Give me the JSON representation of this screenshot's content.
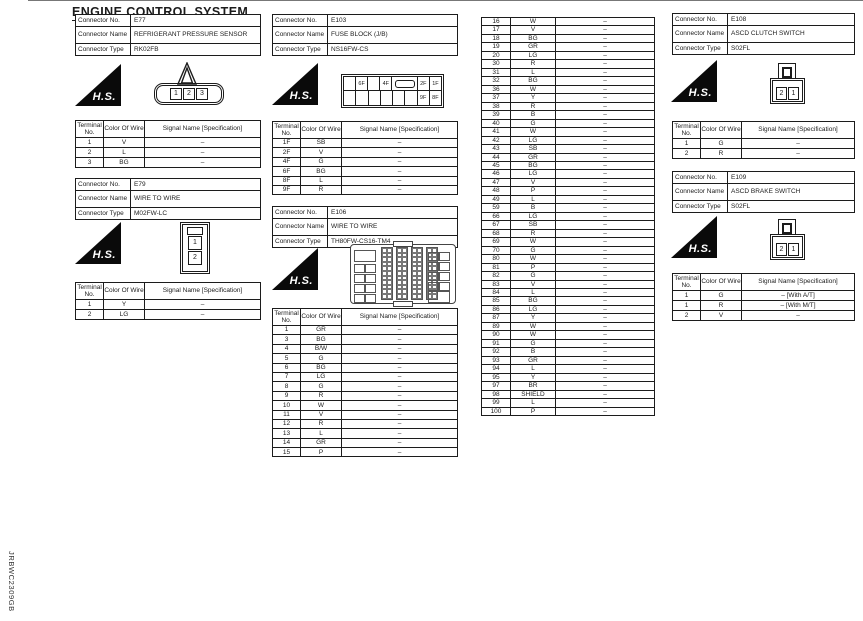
{
  "page": {
    "title": "ENGINE CONTROL SYSTEM",
    "doc_code": "JRBWC2309GB"
  },
  "labels": {
    "connector_no": "Connector No.",
    "connector_name": "Connector Name",
    "connector_type": "Connector Type",
    "terminal_no": "Terminal No.",
    "color_of_wire": "Color Of Wire",
    "signal_name": "Signal Name [Specification]",
    "hs_logo": "H.S."
  },
  "connectors": [
    {
      "no": "E77",
      "name": "REFRIGERANT PRESSURE SENSOR",
      "type": "RK02FB",
      "cavities": [
        "1",
        "2",
        "3"
      ],
      "terminals": [
        [
          "1",
          "V",
          "–"
        ],
        [
          "2",
          "L",
          "–"
        ],
        [
          "3",
          "BG",
          "–"
        ]
      ]
    },
    {
      "no": "E79",
      "name": "WIRE TO WIRE",
      "type": "M02FW-LC",
      "cavities": [
        "1",
        "2"
      ],
      "terminals": [
        [
          "1",
          "Y",
          "–"
        ],
        [
          "2",
          "LG",
          "–"
        ]
      ]
    },
    {
      "no": "E103",
      "name": "FUSE BLOCK (J/B)",
      "type": "NS16FW-CS",
      "fuse_top": [
        "",
        "6F",
        "",
        "4F",
        "",
        "2F",
        "1F"
      ],
      "fuse_bottom": [
        "",
        "",
        "",
        "",
        "",
        "",
        "9F",
        "8F"
      ],
      "terminals": [
        [
          "1F",
          "SB",
          "–"
        ],
        [
          "2F",
          "V",
          "–"
        ],
        [
          "4F",
          "G",
          "–"
        ],
        [
          "6F",
          "BG",
          "–"
        ],
        [
          "8F",
          "L",
          "–"
        ],
        [
          "9F",
          "R",
          "–"
        ]
      ]
    },
    {
      "no": "E106",
      "name": "WIRE TO WIRE",
      "type": "TH80FW-CS16-TM4",
      "terminals": [
        [
          "1",
          "GR",
          "–"
        ],
        [
          "3",
          "BG",
          "–"
        ],
        [
          "4",
          "B/W",
          "–"
        ],
        [
          "5",
          "G",
          "–"
        ],
        [
          "6",
          "BG",
          "–"
        ],
        [
          "7",
          "LG",
          "–"
        ],
        [
          "8",
          "G",
          "–"
        ],
        [
          "9",
          "R",
          "–"
        ],
        [
          "10",
          "W",
          "–"
        ],
        [
          "11",
          "V",
          "–"
        ],
        [
          "12",
          "R",
          "–"
        ],
        [
          "13",
          "L",
          "–"
        ],
        [
          "14",
          "GR",
          "–"
        ],
        [
          "15",
          "P",
          "–"
        ]
      ]
    },
    {
      "no": "E108",
      "name": "ASCD CLUTCH SWITCH",
      "type": "S02FL",
      "cavities": [
        "2",
        "1"
      ],
      "terminals": [
        [
          "1",
          "G",
          "–"
        ],
        [
          "2",
          "R",
          "–"
        ]
      ]
    },
    {
      "no": "E109",
      "name": "ASCD BRAKE SWITCH",
      "type": "S02FL",
      "cavities": [
        "2",
        "1"
      ],
      "terminals": [
        [
          "1",
          "G",
          "– [With A/T]"
        ],
        [
          "1",
          "R",
          "– [With M/T]"
        ],
        [
          "2",
          "V",
          "–"
        ]
      ]
    }
  ],
  "continuation_table": {
    "rows": [
      [
        "16",
        "W",
        "–"
      ],
      [
        "17",
        "V",
        "–"
      ],
      [
        "18",
        "BG",
        "–"
      ],
      [
        "19",
        "GR",
        "–"
      ],
      [
        "20",
        "LG",
        "–"
      ],
      [
        "30",
        "R",
        "–"
      ],
      [
        "31",
        "L",
        "–"
      ],
      [
        "32",
        "BG",
        "–"
      ],
      [
        "36",
        "W",
        "–"
      ],
      [
        "37",
        "Y",
        "–"
      ],
      [
        "38",
        "R",
        "–"
      ],
      [
        "39",
        "B",
        "–"
      ],
      [
        "40",
        "G",
        "–"
      ],
      [
        "41",
        "W",
        "–"
      ],
      [
        "42",
        "LG",
        "–"
      ],
      [
        "43",
        "SB",
        "–"
      ],
      [
        "44",
        "GR",
        "–"
      ],
      [
        "45",
        "BG",
        "–"
      ],
      [
        "46",
        "LG",
        "–"
      ],
      [
        "47",
        "V",
        "–"
      ],
      [
        "48",
        "P",
        "–"
      ],
      [
        "49",
        "L",
        "–"
      ],
      [
        "59",
        "B",
        "–"
      ],
      [
        "66",
        "LG",
        "–"
      ],
      [
        "67",
        "SB",
        "–"
      ],
      [
        "68",
        "R",
        "–"
      ],
      [
        "69",
        "W",
        "–"
      ],
      [
        "70",
        "G",
        "–"
      ],
      [
        "80",
        "W",
        "–"
      ],
      [
        "81",
        "P",
        "–"
      ],
      [
        "82",
        "G",
        "–"
      ],
      [
        "83",
        "V",
        "–"
      ],
      [
        "84",
        "L",
        "–"
      ],
      [
        "85",
        "BG",
        "–"
      ],
      [
        "86",
        "LG",
        "–"
      ],
      [
        "87",
        "Y",
        "–"
      ],
      [
        "89",
        "W",
        "–"
      ],
      [
        "90",
        "W",
        "–"
      ],
      [
        "91",
        "G",
        "–"
      ],
      [
        "92",
        "B",
        "–"
      ],
      [
        "93",
        "GR",
        "–"
      ],
      [
        "94",
        "L",
        "–"
      ],
      [
        "95",
        "Y",
        "–"
      ],
      [
        "97",
        "BR",
        "–"
      ],
      [
        "98",
        "SHIELD",
        "–"
      ],
      [
        "99",
        "L",
        "–"
      ],
      [
        "100",
        "P",
        "–"
      ]
    ]
  }
}
